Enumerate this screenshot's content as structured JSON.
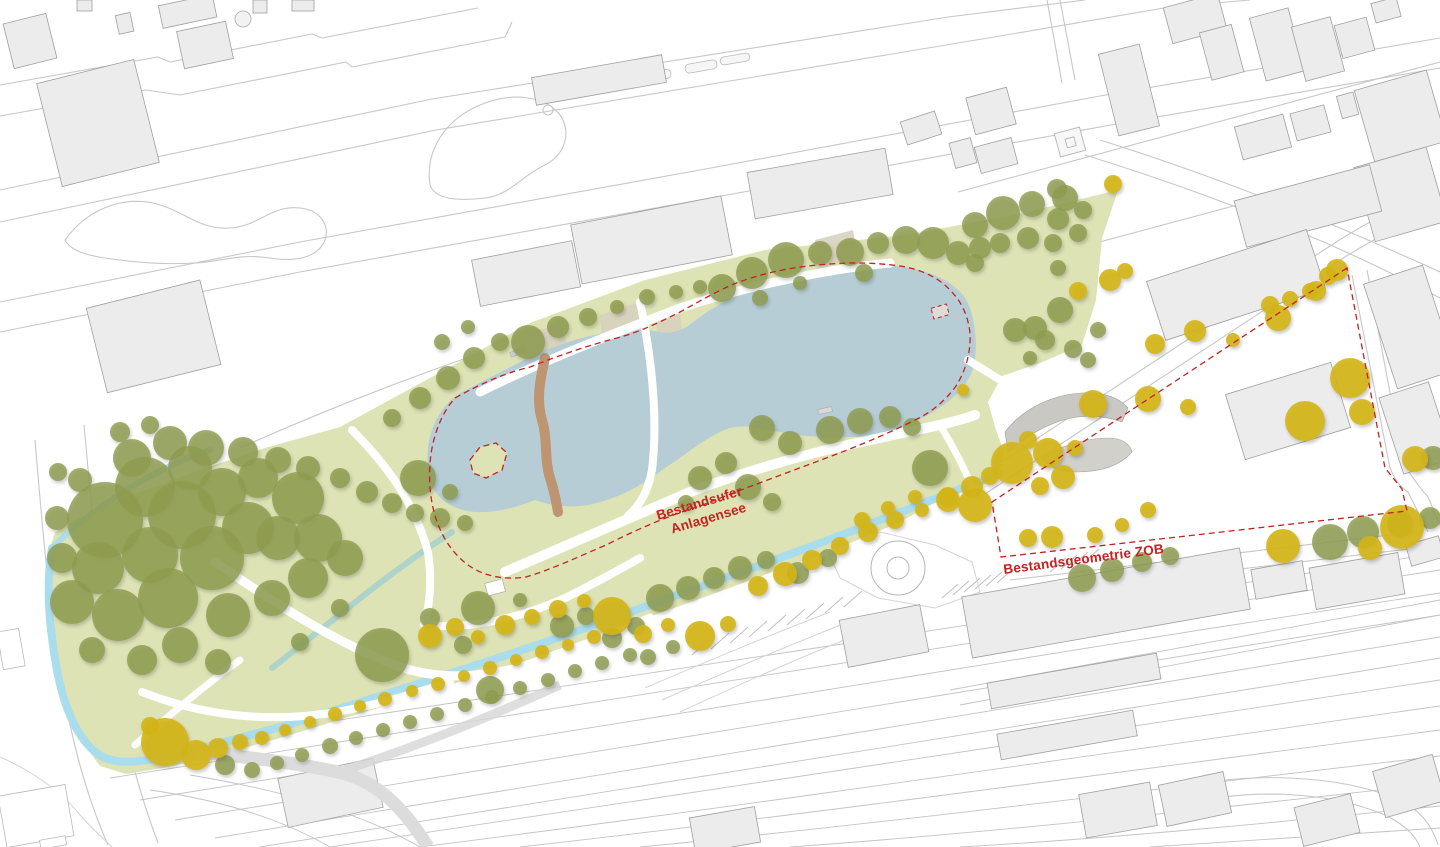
{
  "annotations": {
    "lake_label_line1": "Bestandsufer",
    "lake_label_line2": "Anlagensee",
    "zob_label": "Bestandsgeometrie ZOB"
  },
  "colors": {
    "background": "#ffffff",
    "park_green": "#dde3b4",
    "park_green_dark": "#d5dda4",
    "lake_blue": "#b6cdd6",
    "stream_blue": "#a9dcec",
    "stream_dark": "#8fc8d8",
    "tree_olive": "#8d9b4e",
    "tree_yellow": "#d4b513",
    "path_brown": "#bf9470",
    "beige": "#d8d2bf",
    "building_fill": "#ececec",
    "building_stroke": "#9f9f9f",
    "road_gray": "#c7c7c7",
    "annotation_red": "#c32222",
    "structure_gray": "#cac8c3",
    "structure_gray_light": "#d2d0cb"
  },
  "map_features": {
    "trees_olive": [
      [
        105,
        520,
        38
      ],
      [
        145,
        487,
        30
      ],
      [
        182,
        515,
        34
      ],
      [
        150,
        555,
        28
      ],
      [
        98,
        568,
        26
      ],
      [
        72,
        602,
        22
      ],
      [
        118,
        615,
        26
      ],
      [
        168,
        598,
        30
      ],
      [
        212,
        558,
        32
      ],
      [
        248,
        528,
        26
      ],
      [
        222,
        492,
        24
      ],
      [
        190,
        468,
        22
      ],
      [
        258,
        478,
        20
      ],
      [
        298,
        498,
        26
      ],
      [
        278,
        538,
        22
      ],
      [
        318,
        538,
        24
      ],
      [
        228,
        615,
        22
      ],
      [
        272,
        598,
        18
      ],
      [
        308,
        578,
        20
      ],
      [
        345,
        558,
        18
      ],
      [
        180,
        645,
        18
      ],
      [
        142,
        660,
        15
      ],
      [
        218,
        662,
        13
      ],
      [
        92,
        650,
        13
      ],
      [
        62,
        558,
        15
      ],
      [
        57,
        518,
        12
      ],
      [
        340,
        608,
        9
      ],
      [
        382,
        655,
        27
      ],
      [
        300,
        642,
        9
      ],
      [
        132,
        458,
        19
      ],
      [
        170,
        443,
        17
      ],
      [
        206,
        448,
        18
      ],
      [
        243,
        452,
        15
      ],
      [
        278,
        460,
        13
      ],
      [
        308,
        468,
        12
      ],
      [
        340,
        478,
        10
      ],
      [
        367,
        492,
        11
      ],
      [
        392,
        503,
        10
      ],
      [
        415,
        513,
        9
      ],
      [
        440,
        518,
        10
      ],
      [
        465,
        523,
        8
      ],
      [
        418,
        478,
        18
      ],
      [
        450,
        492,
        8
      ],
      [
        120,
        432,
        10
      ],
      [
        150,
        425,
        9
      ],
      [
        80,
        480,
        12
      ],
      [
        58,
        472,
        9
      ],
      [
        478,
        608,
        17
      ],
      [
        430,
        618,
        10
      ],
      [
        490,
        690,
        14
      ],
      [
        520,
        600,
        7
      ],
      [
        463,
        645,
        9
      ],
      [
        392,
        418,
        9
      ],
      [
        420,
        398,
        11
      ],
      [
        448,
        378,
        12
      ],
      [
        474,
        358,
        11
      ],
      [
        500,
        342,
        9
      ],
      [
        528,
        342,
        17
      ],
      [
        558,
        327,
        11
      ],
      [
        588,
        317,
        9
      ],
      [
        617,
        307,
        7
      ],
      [
        647,
        297,
        8
      ],
      [
        676,
        292,
        7
      ],
      [
        442,
        342,
        8
      ],
      [
        468,
        327,
        7
      ],
      [
        700,
        287,
        7
      ],
      [
        722,
        288,
        14
      ],
      [
        752,
        273,
        16
      ],
      [
        786,
        260,
        18
      ],
      [
        820,
        253,
        12
      ],
      [
        850,
        252,
        14
      ],
      [
        878,
        243,
        11
      ],
      [
        906,
        240,
        14
      ],
      [
        933,
        243,
        16
      ],
      [
        958,
        253,
        12
      ],
      [
        980,
        248,
        11
      ],
      [
        864,
        273,
        9
      ],
      [
        760,
        298,
        8
      ],
      [
        800,
        283,
        7
      ],
      [
        975,
        225,
        13
      ],
      [
        1003,
        213,
        17
      ],
      [
        1032,
        204,
        13
      ],
      [
        1058,
        219,
        11
      ],
      [
        1000,
        243,
        10
      ],
      [
        1028,
        238,
        11
      ],
      [
        1053,
        243,
        9
      ],
      [
        1078,
        233,
        9
      ],
      [
        975,
        263,
        9
      ],
      [
        1058,
        268,
        8
      ],
      [
        1065,
        198,
        13
      ],
      [
        1083,
        210,
        9
      ],
      [
        1057,
        189,
        10
      ],
      [
        1060,
        310,
        13
      ],
      [
        1035,
        328,
        12
      ],
      [
        1015,
        330,
        12
      ],
      [
        1045,
        340,
        10
      ],
      [
        1073,
        349,
        9
      ],
      [
        1030,
        358,
        7
      ],
      [
        1088,
        360,
        8
      ],
      [
        1098,
        330,
        8
      ],
      [
        830,
        430,
        14
      ],
      [
        860,
        421,
        13
      ],
      [
        890,
        417,
        11
      ],
      [
        912,
        427,
        9
      ],
      [
        762,
        428,
        13
      ],
      [
        790,
        443,
        12
      ],
      [
        726,
        463,
        11
      ],
      [
        748,
        487,
        13
      ],
      [
        772,
        502,
        9
      ],
      [
        700,
        478,
        12
      ],
      [
        686,
        503,
        8
      ],
      [
        930,
        468,
        18
      ],
      [
        660,
        598,
        14
      ],
      [
        688,
        588,
        12
      ],
      [
        714,
        578,
        11
      ],
      [
        740,
        568,
        12
      ],
      [
        766,
        560,
        9
      ],
      [
        798,
        573,
        11
      ],
      [
        828,
        558,
        9
      ],
      [
        562,
        626,
        12
      ],
      [
        586,
        616,
        9
      ],
      [
        612,
        638,
        10
      ],
      [
        636,
        626,
        9
      ],
      [
        648,
        657,
        8
      ],
      [
        673,
        647,
        7
      ],
      [
        225,
        765,
        10
      ],
      [
        252,
        770,
        8
      ],
      [
        277,
        763,
        7
      ],
      [
        302,
        755,
        7
      ],
      [
        330,
        746,
        8
      ],
      [
        356,
        738,
        7
      ],
      [
        383,
        730,
        7
      ],
      [
        410,
        722,
        7
      ],
      [
        437,
        714,
        7
      ],
      [
        465,
        705,
        7
      ],
      [
        492,
        697,
        7
      ],
      [
        520,
        688,
        7
      ],
      [
        548,
        680,
        7
      ],
      [
        575,
        671,
        7
      ],
      [
        602,
        663,
        7
      ],
      [
        630,
        655,
        7
      ],
      [
        1082,
        578,
        14
      ],
      [
        1112,
        570,
        12
      ],
      [
        1142,
        562,
        10
      ],
      [
        1170,
        556,
        9
      ],
      [
        1330,
        542,
        18
      ],
      [
        1363,
        532,
        16
      ],
      [
        1400,
        524,
        13
      ],
      [
        1430,
        518,
        11
      ],
      [
        1433,
        458,
        12
      ]
    ],
    "trees_yellow": [
      [
        165,
        742,
        24
      ],
      [
        196,
        755,
        15
      ],
      [
        218,
        748,
        10
      ],
      [
        150,
        726,
        9
      ],
      [
        240,
        742,
        8
      ],
      [
        262,
        738,
        7
      ],
      [
        285,
        730,
        6
      ],
      [
        310,
        722,
        6
      ],
      [
        335,
        714,
        7
      ],
      [
        360,
        706,
        6
      ],
      [
        385,
        699,
        7
      ],
      [
        412,
        691,
        6
      ],
      [
        438,
        684,
        7
      ],
      [
        464,
        676,
        6
      ],
      [
        490,
        668,
        7
      ],
      [
        516,
        660,
        6
      ],
      [
        542,
        652,
        7
      ],
      [
        568,
        645,
        6
      ],
      [
        594,
        637,
        7
      ],
      [
        430,
        636,
        12
      ],
      [
        455,
        627,
        9
      ],
      [
        478,
        637,
        7
      ],
      [
        505,
        625,
        10
      ],
      [
        532,
        617,
        8
      ],
      [
        558,
        609,
        9
      ],
      [
        584,
        601,
        7
      ],
      [
        612,
        616,
        19
      ],
      [
        643,
        634,
        9
      ],
      [
        668,
        625,
        7
      ],
      [
        700,
        636,
        15
      ],
      [
        728,
        624,
        8
      ],
      [
        758,
        586,
        10
      ],
      [
        785,
        574,
        12
      ],
      [
        812,
        560,
        10
      ],
      [
        840,
        546,
        9
      ],
      [
        868,
        532,
        10
      ],
      [
        895,
        520,
        9
      ],
      [
        922,
        510,
        7
      ],
      [
        948,
        500,
        12
      ],
      [
        972,
        487,
        11
      ],
      [
        990,
        476,
        9
      ],
      [
        862,
        520,
        8
      ],
      [
        888,
        508,
        7
      ],
      [
        915,
        497,
        7
      ],
      [
        1012,
        463,
        21
      ],
      [
        1048,
        453,
        15
      ],
      [
        1028,
        440,
        9
      ],
      [
        1075,
        448,
        8
      ],
      [
        1093,
        404,
        14
      ],
      [
        1148,
        399,
        13
      ],
      [
        1188,
        407,
        8
      ],
      [
        975,
        505,
        17
      ],
      [
        948,
        497,
        10
      ],
      [
        963,
        390,
        6
      ],
      [
        1028,
        538,
        9
      ],
      [
        1052,
        537,
        11
      ],
      [
        1095,
        535,
        8
      ],
      [
        1148,
        510,
        8
      ],
      [
        1122,
        525,
        7
      ],
      [
        1040,
        486,
        9
      ],
      [
        1063,
        477,
        12
      ],
      [
        1110,
        280,
        11
      ],
      [
        1125,
        271,
        8
      ],
      [
        1078,
        291,
        9
      ],
      [
        1155,
        344,
        10
      ],
      [
        1195,
        331,
        11
      ],
      [
        1233,
        340,
        7
      ],
      [
        1278,
        318,
        13
      ],
      [
        1316,
        291,
        10
      ],
      [
        1337,
        270,
        11
      ],
      [
        1270,
        305,
        9
      ],
      [
        1290,
        299,
        8
      ],
      [
        1310,
        291,
        8
      ],
      [
        1328,
        276,
        9
      ],
      [
        1305,
        421,
        20
      ],
      [
        1350,
        378,
        20
      ],
      [
        1362,
        412,
        13
      ],
      [
        1415,
        459,
        13
      ],
      [
        1283,
        546,
        17
      ],
      [
        1402,
        527,
        22
      ],
      [
        1370,
        548,
        12
      ],
      [
        1113,
        184,
        9
      ]
    ]
  }
}
